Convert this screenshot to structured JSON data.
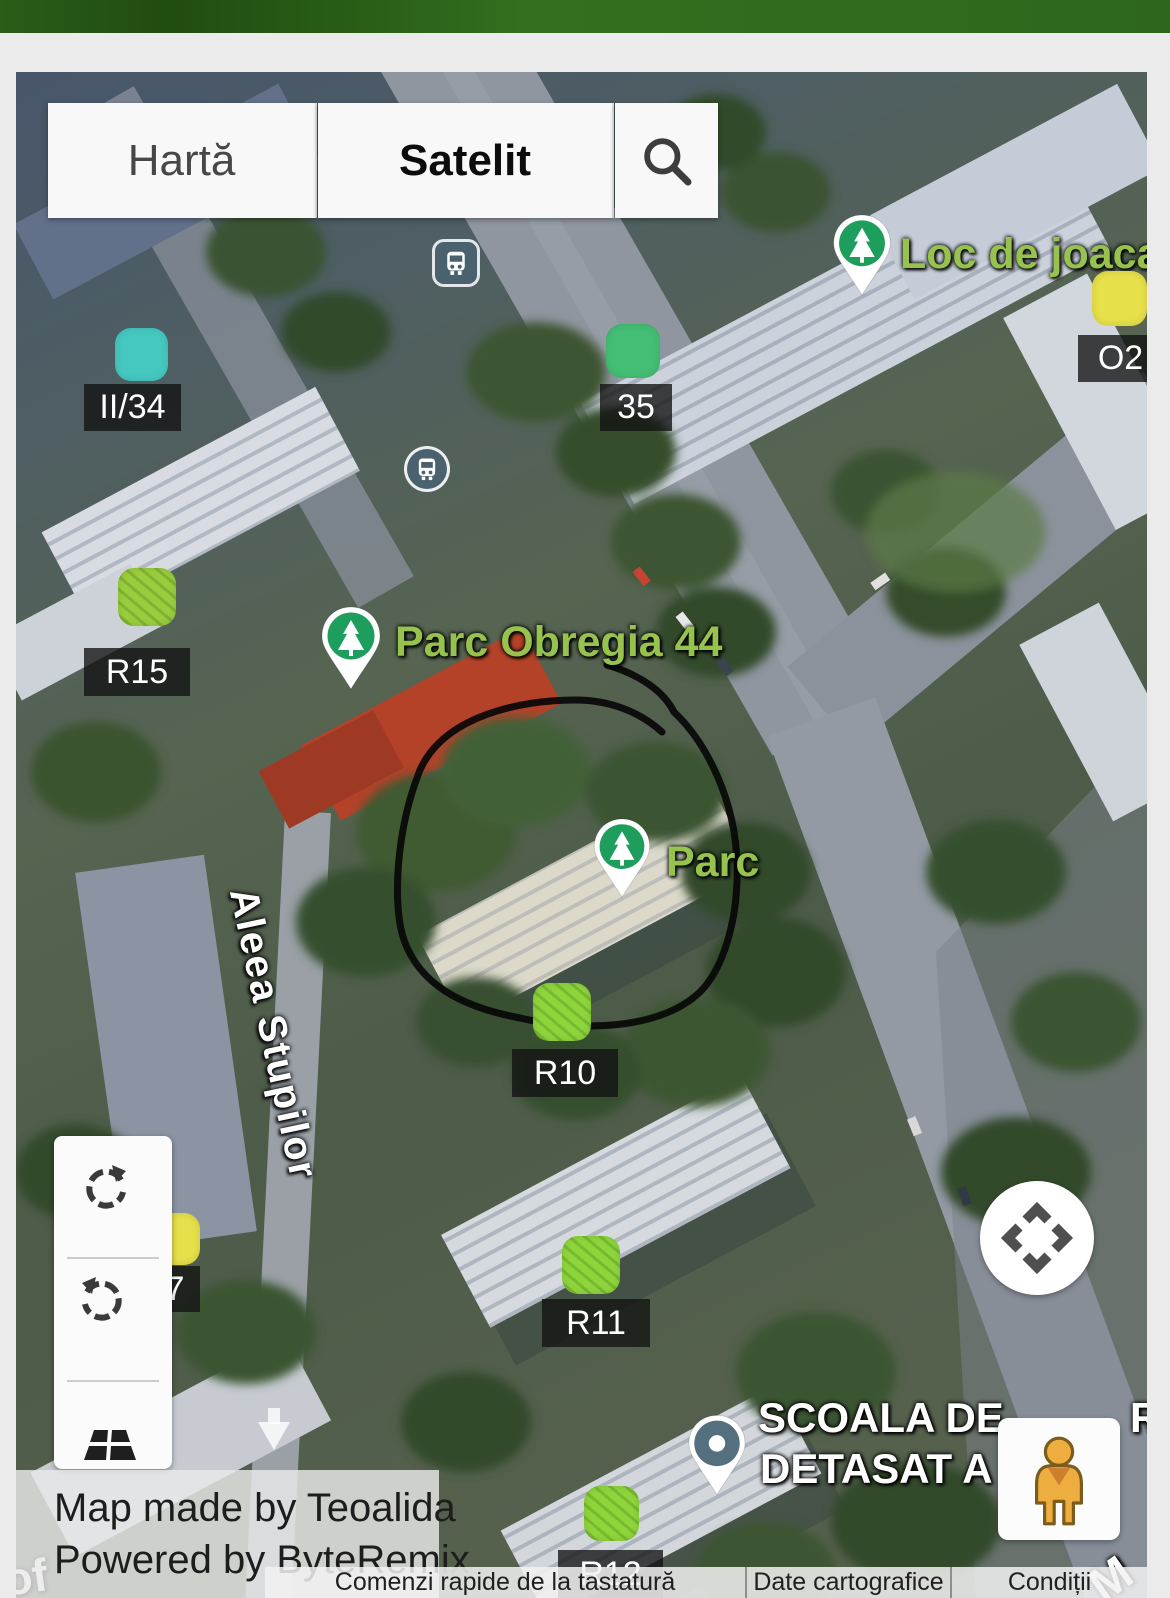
{
  "colors": {
    "header_green": "#2E6B1C",
    "marker_cyan": "#45C8C0",
    "marker_green": "#44BE74",
    "marker_lime": "#8ED53C",
    "marker_yellow": "#E6E04A",
    "poi_text_green": "#96C24D",
    "park_pin_green": "#1E9E5C",
    "bus_icon_slate": "#4A616E",
    "school_pin_slate": "#54707E",
    "pegman_orange": "#EDAE3F"
  },
  "toolbar": {
    "map_label": "Hartă",
    "satellite_label": "Satelit"
  },
  "markers": [
    {
      "label": "II/34",
      "color": "#45C8C0"
    },
    {
      "label": "35",
      "color": "#44BE74"
    },
    {
      "label": "R15",
      "color": "#9ACD3E"
    },
    {
      "label": "R10",
      "color": "#8ED53C"
    },
    {
      "label": "7",
      "color": "#E6E04A"
    },
    {
      "label": "R11",
      "color": "#8ED53C"
    },
    {
      "label": "R12",
      "color": "#8ED53C"
    },
    {
      "label": "O2",
      "color": "#E6E04A"
    }
  ],
  "poi": {
    "playground_label": "Loc de joaca",
    "park_obregia_label": "Parc Obregia 44",
    "park_label": "Parc",
    "school_line1": "SCOALA DE",
    "school_line1_fragment": "R",
    "school_line2": "DETASAT A"
  },
  "streets": {
    "aleea_stupilor": "Aleea Stupilor",
    "fragment_bottom_left": "of",
    "fragment_bottom_right": "M"
  },
  "attribution": {
    "line1": "Map made by Teoalida",
    "line2": "Powered by ByteRemix"
  },
  "footer": {
    "items": [
      {
        "label": "Comenzi rapide de la tastatură"
      },
      {
        "label": "Date cartografice"
      },
      {
        "label": "Condiții"
      }
    ]
  }
}
